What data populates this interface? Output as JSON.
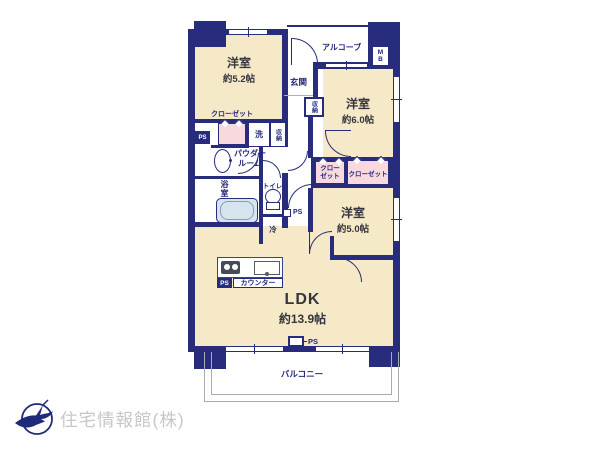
{
  "rooms": {
    "west52": {
      "name": "洋室",
      "size": "約5.2帖"
    },
    "west60": {
      "name": "洋室",
      "size": "約6.0帖"
    },
    "west50": {
      "name": "洋室",
      "size": "約5.0帖"
    },
    "ldk": {
      "name": "LDK",
      "size": "約13.9帖"
    }
  },
  "labels": {
    "alcove": "アルコーブ",
    "meter_box": "MB",
    "entrance": "玄関",
    "storage_entrance": "収納",
    "storage_laundry": "収納",
    "closet_west52": "クローゼット",
    "closet_mid_small": "クローゼット",
    "closet_mid_large": "クローゼット",
    "laundry": "洗",
    "powder_room": "パウダールーム",
    "bath": "浴室",
    "toilet": "トイレ",
    "fridge": "冷",
    "counter": "カウンター",
    "balcony": "バルコニー",
    "ps": "PS"
  },
  "footer": {
    "company": "住宅情報館(株)"
  },
  "colors": {
    "wall": "#272c7d",
    "room_fill": "#f6e9c8",
    "closet_fill": "#f8d9de",
    "tub_fill": "#d6e4ee",
    "label_text": "#23297b",
    "room_text": "#35363d",
    "logo_text": "#c7c7c5"
  }
}
